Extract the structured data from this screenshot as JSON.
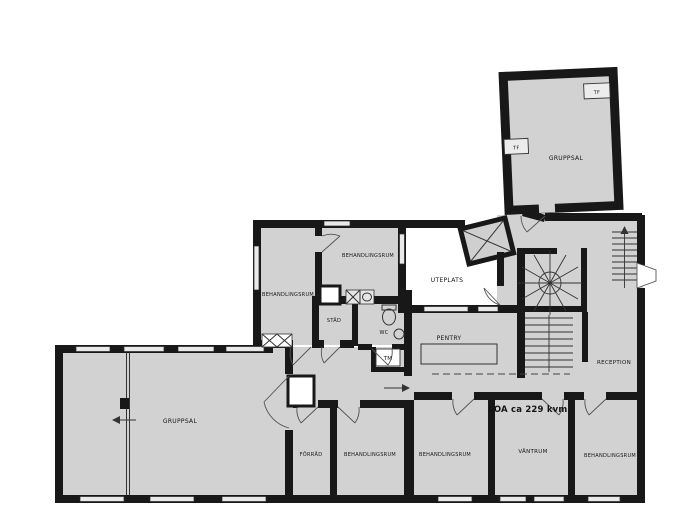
{
  "floorplan": {
    "area_note": "LOA ca 229 kvm",
    "rooms": {
      "gruppsal_upper": "GRUPPSAL",
      "gruppsal_main": "GRUPPSAL",
      "behandlingsrum_west": "BEHANDLINGSRUM",
      "behandlingsrum_north": "BEHANDLINGSRUM",
      "behandlingsrum_south_1": "BEHANDLINGSRUM",
      "behandlingsrum_south_2": "BEHANDLINGSRUM",
      "behandlingsrum_southeast": "BEHANDLINGSRUM",
      "stad": "STÄD",
      "wc": "WC",
      "uteplats": "UTEPLATS",
      "pentry": "PENTRY",
      "reception": "RECEPTION",
      "forrad": "FÖRRÅD",
      "vantrum": "VÄNTRUM"
    },
    "fixtures": {
      "tf_west": "TF",
      "tf_east": "TF",
      "tm": "TM"
    },
    "colors": {
      "room_fill": "#d2d2d2",
      "wall": "#181818",
      "outdoor_fill": "#ffffff",
      "window_fill": "#e9e9e9",
      "background": "#ffffff"
    }
  }
}
